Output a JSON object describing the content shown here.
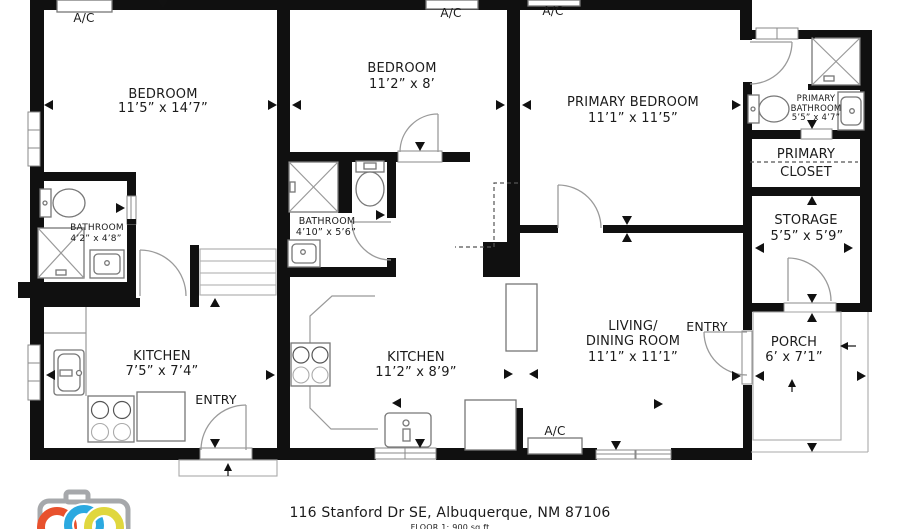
{
  "rooms": {
    "bedroom_1": {
      "name": "BEDROOM",
      "dims": "11’5” x 14’7”"
    },
    "bedroom_2": {
      "name": "BEDROOM",
      "dims": "11’2” x 8’"
    },
    "primary_bedroom": {
      "name": "PRIMARY BEDROOM",
      "dims": "11’1” x 11’5”"
    },
    "living_dining": {
      "line1": "LIVING/",
      "line2": "DINING ROOM",
      "dims": "11’1” x 11’1”"
    },
    "kitchen_1": {
      "name": "KITCHEN",
      "dims": "7’5” x 7’4”"
    },
    "kitchen_2": {
      "name": "KITCHEN",
      "dims": "11’2” x 8’9”"
    },
    "bathroom_1": {
      "name": "BATHROOM",
      "dims": "4’2” x 4’8”"
    },
    "bathroom_2": {
      "name": "BATHROOM",
      "dims": "4’10” x 5’6”"
    },
    "primary_bathroom": {
      "line1": "PRIMARY",
      "line2": "BATHROOM",
      "dims": "5’5” x 4’7”"
    },
    "primary_closet": {
      "line1": "PRIMARY",
      "line2": "CLOSET"
    },
    "storage": {
      "name": "STORAGE",
      "dims": "5’5” x 5’9”"
    },
    "porch": {
      "name": "PORCH",
      "dims": "6’ x 7’1”"
    }
  },
  "labels": {
    "ac": "A/C",
    "entry": "ENTRY"
  },
  "footer": {
    "address": "116 Stanford Dr SE, Albuquerque, NM 87106",
    "floor": "FLOOR 1: 900 sq ft"
  },
  "logo": {
    "camera_outline": "#a6a8ab",
    "ring_red": "#e8512d",
    "ring_blue": "#2ba9e0",
    "ring_yellow": "#e0d73e",
    "ring_gap": "#ffffff"
  }
}
